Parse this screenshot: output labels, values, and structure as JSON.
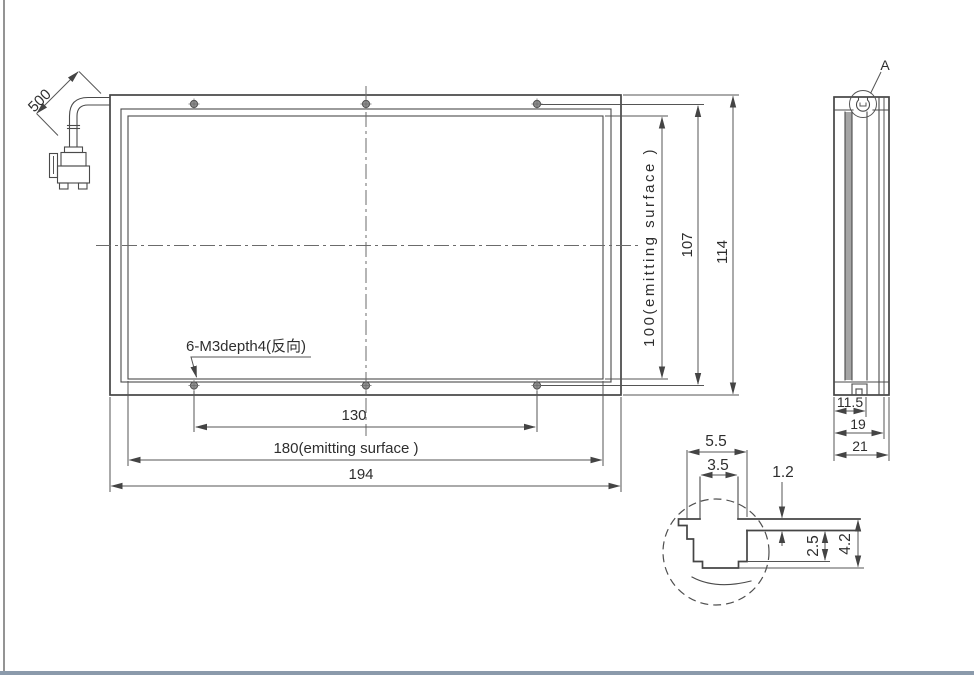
{
  "drawing": {
    "front_view": {
      "cable_length": "500",
      "hole_callout": "6-M3depth4(反向)",
      "dim_hole_spacing_x": "130",
      "dim_emitting_width": "180(emitting surface )",
      "dim_overall_width": "194",
      "dim_emitting_height": "100(emitting surface )",
      "dim_hole_spacing_y": "107",
      "dim_overall_height": "114"
    },
    "side_view": {
      "detail_label": "A",
      "dim_inner_width": "11.5",
      "dim_body_width": "19",
      "dim_overall_width": "21"
    },
    "detail_view": {
      "dim_slot_outer_width": "5.5",
      "dim_slot_inner_width": "3.5",
      "dim_lip_thickness": "1.2",
      "dim_slot_depth": "2.5",
      "dim_total_depth": "4.2"
    },
    "colors": {
      "line": "#454545",
      "dimension": "#4f4f4f",
      "shaded_strip": "#a5a5a5",
      "page_edge": "#949494",
      "bottom_bar": "#8b9aab"
    }
  }
}
